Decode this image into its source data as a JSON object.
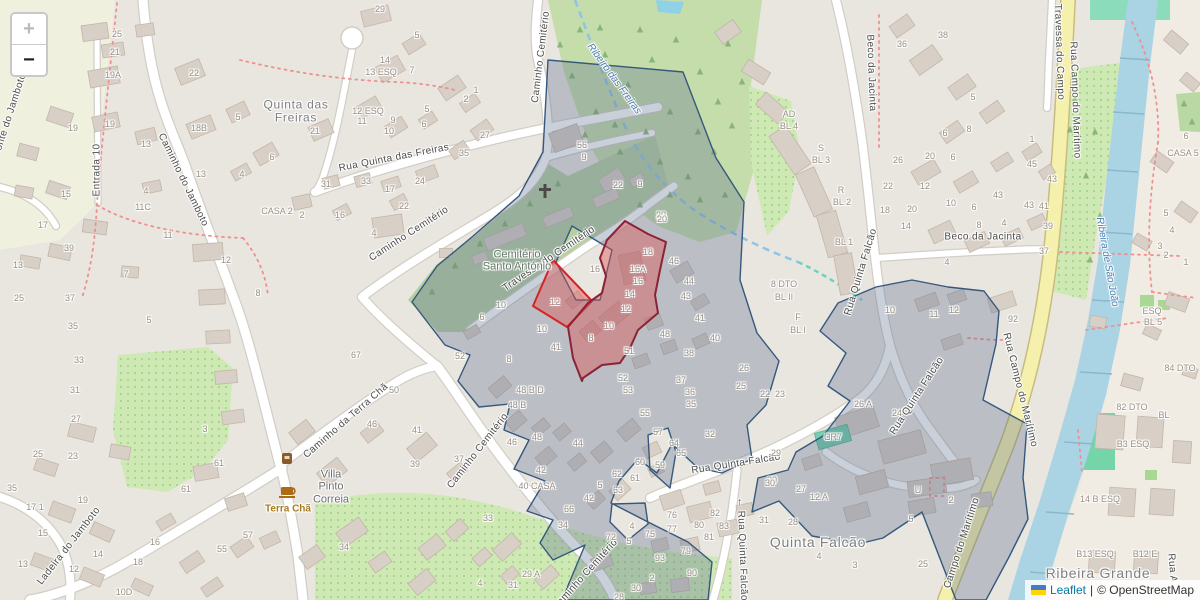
{
  "app": {
    "type": "leaflet-map",
    "controls": {
      "zoom_in": "+",
      "zoom_out": "−"
    },
    "attribution": {
      "flag": "ukraine-flag",
      "leaflet_label": "Leaflet",
      "separator": "|",
      "osm_label": "© OpenStreetMap"
    }
  },
  "colors": {
    "land": "#e9e6e0",
    "field": "#eff0de",
    "right_bank": "#f1ece3",
    "wood": "#c5dcab",
    "cemetery_green": "#b6cfa2",
    "orchard": "#cfe9b4",
    "pitch": "#8bdcba",
    "river": "#aad4e4",
    "stream": "#8ec4e8",
    "culvert": "#6fd0c4",
    "road_fill": "#ffffff",
    "road_casing": "#d2cec7",
    "yellow_road": "#f5f0ac",
    "yellow_casing": "#c8bc80",
    "building": "#d8cfc6",
    "building_stroke": "#c3b6a9",
    "path_red": "#ee9090",
    "overlay_blue_stroke": "#35587c",
    "overlay_blue_fill": "rgba(90,110,140,0.32)",
    "overlay_red_fill": "rgba(224,80,80,0.42)",
    "overlay_red_stroke_small": "#d42424",
    "overlay_red_stroke_large": "#8b2236",
    "cr7_building": "#74cfae"
  },
  "map": {
    "labels": {
      "streets": [
        [
          "Fonte do Jamboto",
          10,
          115,
          -72
        ],
        [
          "Entrada 10",
          97,
          170,
          -90
        ],
        [
          "Caminho do Jamboto",
          183,
          180,
          64
        ],
        [
          "Rua Quinta das Freiras",
          394,
          158,
          -11
        ],
        [
          "Caminho Cemitério",
          409,
          234,
          -33
        ],
        [
          "Caminho Cemitério",
          541,
          57,
          -83
        ],
        [
          "Travessa do Cemitério",
          549,
          259,
          -34
        ],
        [
          "Caminho Cemitério",
          478,
          451,
          -52
        ],
        [
          "Caminho Cemitério",
          585,
          575,
          -48
        ],
        [
          "Caminho da Terra Chã",
          346,
          421,
          -41
        ],
        [
          "Ladeira do Jamboto",
          69,
          546,
          -52
        ],
        [
          "Beco da Jacinta",
          871,
          73,
          88
        ],
        [
          "Beco da Jacinta",
          983,
          237,
          0
        ],
        [
          "Rua Quinta Falcão",
          861,
          272,
          -73
        ],
        [
          "Rua Quinta Falcão",
          917,
          396,
          -57
        ],
        [
          "Rua Quinta Falcão",
          736,
          464,
          -9
        ],
        [
          "← Rua Quinta Falcão",
          742,
          549,
          88
        ],
        [
          "Travessa do Campo",
          1059,
          52,
          88
        ],
        [
          "Rua Campo do Marítimo",
          1075,
          100,
          88
        ],
        [
          "Rua Campo do Marítimo",
          1020,
          390,
          76
        ],
        [
          "Campo do Marítimo",
          962,
          543,
          -72
        ],
        [
          "Rua A",
          1172,
          568,
          85
        ]
      ],
      "water": [
        [
          "Ribeiro das Freiras",
          614,
          79,
          54
        ],
        [
          "Ribeira de São João",
          1107,
          262,
          80
        ]
      ],
      "places": [
        [
          "Ribeira Grande",
          1098,
          574,
          14
        ],
        [
          "Quinta Falcão",
          818,
          543,
          14
        ]
      ],
      "multiline": [
        {
          "cls": "place",
          "size": 12,
          "x": 296,
          "y": 112,
          "lines": [
            "Quinta das",
            "Freiras"
          ]
        },
        {
          "cls": "area",
          "x": 517,
          "y": 261,
          "lines": [
            "Cemitério",
            "Santo António"
          ]
        },
        {
          "cls": "villa",
          "x": 331,
          "y": 487,
          "lines": [
            "Villa",
            "Pinto",
            "Correia"
          ]
        }
      ],
      "poi": [
        [
          "Terra Chã",
          288,
          509
        ]
      ],
      "houses": [
        [
          "25",
          117,
          34
        ],
        [
          "21",
          115,
          52
        ],
        [
          "19A",
          113,
          75
        ],
        [
          "22",
          194,
          73
        ],
        [
          "19",
          73,
          128
        ],
        [
          "19",
          110,
          124
        ],
        [
          "18B",
          199,
          128
        ],
        [
          "13",
          146,
          144
        ],
        [
          "5",
          238,
          117
        ],
        [
          "6",
          272,
          157
        ],
        [
          "4",
          242,
          174
        ],
        [
          "13",
          201,
          174
        ],
        [
          "15",
          66,
          194
        ],
        [
          "4",
          146,
          191
        ],
        [
          "17",
          43,
          225
        ],
        [
          "11C",
          143,
          207
        ],
        [
          "11",
          168,
          235
        ],
        [
          "13",
          18,
          265
        ],
        [
          "39",
          69,
          248
        ],
        [
          "12",
          226,
          260
        ],
        [
          "8",
          258,
          293
        ],
        [
          "25",
          19,
          298
        ],
        [
          "37",
          70,
          298
        ],
        [
          "7",
          126,
          274
        ],
        [
          "35",
          73,
          326
        ],
        [
          "5",
          149,
          320
        ],
        [
          "33",
          79,
          360
        ],
        [
          "31",
          75,
          390
        ],
        [
          "29",
          380,
          9
        ],
        [
          "5",
          417,
          35
        ],
        [
          "14",
          385,
          60
        ],
        [
          "13 ESQ",
          381,
          72
        ],
        [
          "7",
          412,
          70
        ],
        [
          "1",
          476,
          90
        ],
        [
          "2",
          466,
          99
        ],
        [
          "12 ESQ",
          368,
          111
        ],
        [
          "11",
          362,
          121
        ],
        [
          "9",
          393,
          120
        ],
        [
          "5",
          427,
          109
        ],
        [
          "6",
          424,
          124
        ],
        [
          "10",
          389,
          131
        ],
        [
          "21",
          315,
          131
        ],
        [
          "27",
          485,
          135
        ],
        [
          "35",
          464,
          153
        ],
        [
          "24",
          420,
          181
        ],
        [
          "17",
          390,
          189
        ],
        [
          "33",
          366,
          181
        ],
        [
          "31",
          326,
          184
        ],
        [
          "56",
          582,
          145
        ],
        [
          "9",
          584,
          157
        ],
        [
          "CASA 2",
          277,
          211
        ],
        [
          "16",
          340,
          215
        ],
        [
          "22",
          404,
          206
        ],
        [
          "4",
          374,
          233
        ],
        [
          "2",
          302,
          215
        ],
        [
          "22",
          618,
          185
        ],
        [
          "9",
          640,
          184
        ],
        [
          "20",
          661,
          215
        ],
        [
          "18",
          885,
          210
        ],
        [
          "26",
          898,
          160
        ],
        [
          "22",
          888,
          186
        ],
        [
          "38",
          943,
          35
        ],
        [
          "36",
          902,
          44
        ],
        [
          "5",
          973,
          97
        ],
        [
          "6",
          945,
          133
        ],
        [
          "8",
          969,
          129
        ],
        [
          "20",
          930,
          156
        ],
        [
          "6",
          953,
          157
        ],
        [
          "12",
          925,
          186
        ],
        [
          "1",
          1032,
          139
        ],
        [
          "45",
          1032,
          164
        ],
        [
          "43",
          1052,
          179
        ],
        [
          "43",
          998,
          195
        ],
        [
          "6",
          1186,
          136
        ],
        [
          "CASA 5",
          1183,
          153
        ],
        [
          "20",
          912,
          209
        ],
        [
          "14",
          906,
          226
        ],
        [
          "10",
          951,
          203
        ],
        [
          "6",
          974,
          207
        ],
        [
          "8",
          979,
          225
        ],
        [
          "4",
          1004,
          223
        ],
        [
          "43",
          1029,
          205
        ],
        [
          "41",
          1044,
          206
        ],
        [
          "39",
          1048,
          226
        ],
        [
          "37",
          1044,
          251
        ],
        [
          "4",
          947,
          262
        ],
        [
          "11",
          934,
          314
        ],
        [
          "12",
          954,
          310
        ],
        [
          "92",
          1013,
          319
        ],
        [
          "5",
          1166,
          213
        ],
        [
          "4",
          1172,
          230
        ],
        [
          "3",
          1160,
          246
        ],
        [
          "2",
          1166,
          255
        ],
        [
          "1",
          1186,
          262
        ],
        [
          "20",
          662,
          219
        ],
        [
          "18",
          648,
          252
        ],
        [
          "16A",
          638,
          269
        ],
        [
          "16",
          638,
          281
        ],
        [
          "14",
          630,
          294
        ],
        [
          "12",
          626,
          309
        ],
        [
          "10",
          609,
          326
        ],
        [
          "8",
          591,
          338
        ],
        [
          "12",
          555,
          302
        ],
        [
          "16",
          595,
          269
        ],
        [
          "46",
          674,
          261
        ],
        [
          "44",
          689,
          281
        ],
        [
          "43",
          686,
          296
        ],
        [
          "41",
          700,
          318
        ],
        [
          "48",
          665,
          334
        ],
        [
          "40",
          715,
          338
        ],
        [
          "38",
          689,
          353
        ],
        [
          "51",
          629,
          351
        ],
        [
          "52",
          623,
          378
        ],
        [
          "53",
          628,
          390
        ],
        [
          "37",
          681,
          380
        ],
        [
          "36",
          690,
          392
        ],
        [
          "26",
          744,
          368
        ],
        [
          "25",
          741,
          386
        ],
        [
          "22",
          765,
          394
        ],
        [
          "23",
          780,
          394
        ],
        [
          "10",
          890,
          310
        ],
        [
          "10",
          501,
          305
        ],
        [
          "6",
          482,
          317
        ],
        [
          "10",
          542,
          329
        ],
        [
          "41",
          556,
          347
        ],
        [
          "8",
          509,
          359
        ],
        [
          "52",
          460,
          356
        ],
        [
          "67",
          356,
          355
        ],
        [
          "50",
          394,
          390
        ],
        [
          "48 B D",
          530,
          390
        ],
        [
          "48 B",
          517,
          405
        ],
        [
          "48",
          537,
          437
        ],
        [
          "46",
          512,
          442
        ],
        [
          "44",
          578,
          443
        ],
        [
          "42",
          541,
          470
        ],
        [
          "40 CASA",
          537,
          486
        ],
        [
          "34",
          563,
          525
        ],
        [
          "66",
          569,
          509
        ],
        [
          "42",
          589,
          498
        ],
        [
          "5",
          600,
          485
        ],
        [
          "62",
          617,
          474
        ],
        [
          "63",
          618,
          490
        ],
        [
          "61",
          635,
          478
        ],
        [
          "60",
          640,
          462
        ],
        [
          "59",
          660,
          465
        ],
        [
          "64",
          674,
          443
        ],
        [
          "65",
          681,
          453
        ],
        [
          "57",
          658,
          432
        ],
        [
          "55",
          645,
          413
        ],
        [
          "35",
          691,
          404
        ],
        [
          "32",
          710,
          434
        ],
        [
          "29",
          776,
          453
        ],
        [
          "30",
          772,
          480
        ],
        [
          "31",
          764,
          520
        ],
        [
          "28",
          793,
          522
        ],
        [
          "72",
          611,
          537
        ],
        [
          "5",
          629,
          541
        ],
        [
          "75",
          650,
          534
        ],
        [
          "76",
          672,
          515
        ],
        [
          "77",
          672,
          529
        ],
        [
          "4",
          632,
          526
        ],
        [
          "80",
          699,
          525
        ],
        [
          "81",
          709,
          537
        ],
        [
          "82",
          715,
          513
        ],
        [
          "83",
          724,
          526
        ],
        [
          "79",
          686,
          551
        ],
        [
          "93",
          660,
          558
        ],
        [
          "90",
          692,
          573
        ],
        [
          "2",
          652,
          578
        ],
        [
          "30",
          636,
          588
        ],
        [
          "28",
          619,
          597
        ],
        [
          "31",
          513,
          585
        ],
        [
          "29 A",
          531,
          574
        ],
        [
          "27",
          801,
          489
        ],
        [
          "30",
          770,
          483
        ],
        [
          "12 A",
          819,
          497
        ],
        [
          "27",
          76,
          419
        ],
        [
          "3",
          205,
          429
        ],
        [
          "25",
          38,
          454
        ],
        [
          "23",
          73,
          456
        ],
        [
          "35",
          12,
          488
        ],
        [
          "61",
          219,
          463
        ],
        [
          "61",
          186,
          489
        ],
        [
          "19",
          83,
          500
        ],
        [
          "17 1",
          35,
          507
        ],
        [
          "15",
          43,
          533
        ],
        [
          "57",
          248,
          535
        ],
        [
          "55",
          222,
          549
        ],
        [
          "13",
          23,
          564
        ],
        [
          "14",
          98,
          554
        ],
        [
          "12",
          74,
          569
        ],
        [
          "16",
          155,
          542
        ],
        [
          "18",
          138,
          562
        ],
        [
          "10D",
          124,
          592
        ],
        [
          "46",
          372,
          424
        ],
        [
          "41",
          417,
          430
        ],
        [
          "39",
          415,
          464
        ],
        [
          "37",
          459,
          459
        ],
        [
          "33",
          488,
          518
        ],
        [
          "34",
          344,
          547
        ],
        [
          "4",
          480,
          583
        ],
        [
          "26 A",
          863,
          404
        ],
        [
          "24",
          897,
          413
        ],
        [
          "CR7",
          833,
          437
        ],
        [
          "U",
          918,
          490
        ],
        [
          "2",
          951,
          500
        ],
        [
          "5",
          911,
          519
        ],
        [
          "4",
          819,
          556
        ],
        [
          "3",
          855,
          565
        ],
        [
          "25",
          923,
          564
        ],
        [
          "82 DTO",
          1132,
          407
        ],
        [
          "BL",
          1164,
          415
        ],
        [
          "B3 ESQ",
          1133,
          444
        ],
        [
          "14 B ESQ",
          1100,
          499
        ],
        [
          "B13 ESQ",
          1095,
          554
        ],
        [
          "B12 E",
          1145,
          554
        ],
        [
          "84 DTO",
          1180,
          368
        ],
        [
          "ESQ",
          1152,
          311
        ],
        [
          "BL 5",
          1153,
          322
        ],
        [
          "AD",
          789,
          114
        ],
        [
          "BL 4",
          789,
          126
        ],
        [
          "S",
          821,
          148
        ],
        [
          "BL 3",
          821,
          160
        ],
        [
          "R",
          841,
          190
        ],
        [
          "BL 2",
          842,
          202
        ],
        [
          "BL 1",
          844,
          242
        ],
        [
          "8 DTO",
          784,
          284
        ],
        [
          "BL II",
          784,
          297
        ],
        [
          "F",
          798,
          317
        ],
        [
          "BL I",
          798,
          330
        ]
      ]
    }
  }
}
